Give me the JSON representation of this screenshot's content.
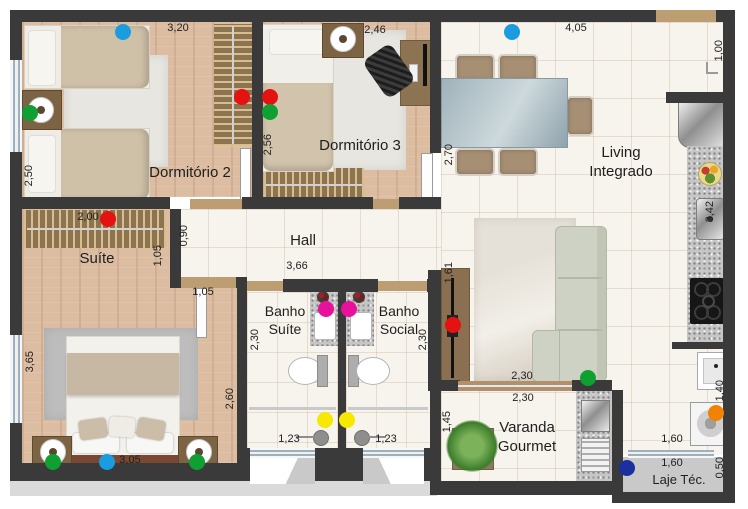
{
  "rooms": {
    "dorm2": "Dormitório 2",
    "dorm3": "Dormitório 3",
    "living_line1": "Living",
    "living_line2": "Integrado",
    "hall": "Hall",
    "suite": "Suíte",
    "banho_suite_line1": "Banho",
    "banho_suite_line2": "Suíte",
    "banho_social_line1": "Banho",
    "banho_social_line2": "Social",
    "varanda_line1": "Varanda",
    "varanda_line2": "Gourmet",
    "laje": "Laje Téc."
  },
  "dims": {
    "dorm2_width": "3,20",
    "dorm2_depth": "2,50",
    "dorm3_width": "2,46",
    "dorm3_depth": "2,56",
    "living_width": "4,05",
    "living_depth": "2,70",
    "entry_side": "1,00",
    "suite_wardrobe": "2,00",
    "hall_side": "0,90",
    "hall_width": "3,66",
    "suite_nook": "1,05",
    "suite_door": "1,05",
    "suite_depth": "3,65",
    "suite_side": "2,60",
    "suite_bed_width": "3,05",
    "banho_suite_depth": "2,30",
    "banho_social_depth": "2,30",
    "banho_suite_width": "1,23",
    "banho_social_width": "1,23",
    "tv_wall": "1,61",
    "sofa_front": "2,30",
    "varanda_width": "2,30",
    "varanda_depth": "1,45",
    "kitchen_counter": "3,42",
    "laundry_depth": "1,40",
    "laundry_width": "1,60",
    "laje_width": "1,60",
    "laje_depth": "0,50"
  },
  "markers": [
    {
      "color": "blue",
      "hex": "#1b9cdf",
      "location": "dormitorio-2-bed"
    },
    {
      "color": "green",
      "hex": "#0fa031",
      "location": "dormitorio-2-nightstand"
    },
    {
      "color": "red",
      "hex": "#e51212",
      "location": "dormitorio-2-wardrobe"
    },
    {
      "color": "red",
      "hex": "#e51212",
      "location": "dormitorio-3-bed"
    },
    {
      "color": "green",
      "hex": "#0fa031",
      "location": "dormitorio-3-bed"
    },
    {
      "color": "blue",
      "hex": "#1b9cdf",
      "location": "living-dining"
    },
    {
      "color": "red",
      "hex": "#e51212",
      "location": "suite-wardrobe"
    },
    {
      "color": "red",
      "hex": "#e51212",
      "location": "living-tv"
    },
    {
      "color": "magenta",
      "hex": "#e8119c",
      "location": "banho-suite-sink"
    },
    {
      "color": "magenta",
      "hex": "#e8119c",
      "location": "banho-social-sink"
    },
    {
      "color": "yellow",
      "hex": "#f6e800",
      "location": "banho-suite-shower"
    },
    {
      "color": "yellow",
      "hex": "#f6e800",
      "location": "banho-social-shower"
    },
    {
      "color": "green",
      "hex": "#0fa031",
      "location": "suite-nightstand-left"
    },
    {
      "color": "blue",
      "hex": "#1b9cdf",
      "location": "suite-bed"
    },
    {
      "color": "green",
      "hex": "#0fa031",
      "location": "suite-nightstand-right"
    },
    {
      "color": "green",
      "hex": "#0fa031",
      "location": "living-sofa"
    },
    {
      "color": "orange",
      "hex": "#f28300",
      "location": "washing-machine"
    },
    {
      "color": "navy",
      "hex": "#1b2f9e",
      "location": "laje-tecnica"
    }
  ],
  "colors": {
    "wall": "#3a3a3a",
    "wood_floor": "#dcbda1",
    "tile_floor": "#f7f3ed",
    "granite": "#c6c6c6",
    "door": "#bd9d72"
  }
}
